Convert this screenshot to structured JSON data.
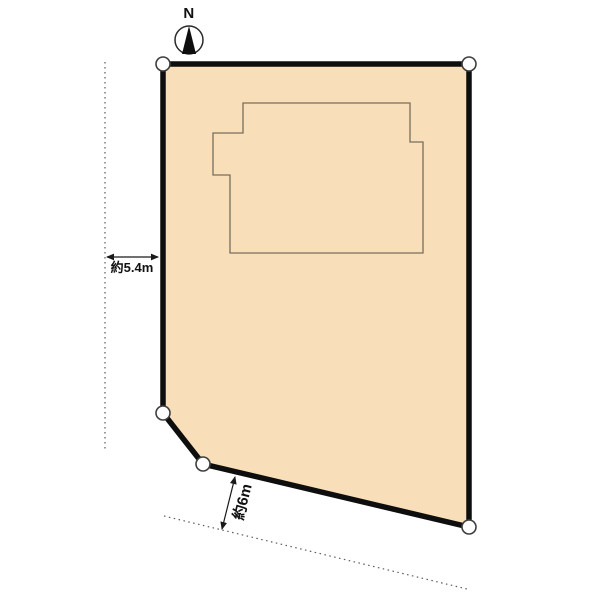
{
  "compass": {
    "label": "N"
  },
  "labels": {
    "left_dimension": "約5.4m",
    "road_dimension": "約6m"
  },
  "colors": {
    "background": "#ffffff",
    "plot_fill": "#f8dfb9",
    "plot_border": "#0e0e0e",
    "building_outline": "#776f5c",
    "boundary_dotted": "#5a5a5a",
    "vertex_fill": "#ffffff",
    "vertex_stroke": "#3e3e3e",
    "dimension_line": "#1a1a1a",
    "compass_ring": "#2a2a2a",
    "compass_needle": "#0e0e0e"
  },
  "diagram": {
    "type": "land-site-plan",
    "plot_points": "163,64 469,64 469,527 203,464 163,413",
    "building_points": "243,103 410,103 410,142 423,142 423,253 230,253 230,175 213,175 213,133 243,133",
    "vertex_markers": [
      [
        163,
        64
      ],
      [
        469,
        64
      ],
      [
        469,
        527
      ],
      [
        203,
        464
      ],
      [
        163,
        413
      ]
    ],
    "reference_line_left": {
      "x1": 105,
      "y1": 62,
      "x2": 105,
      "y2": 449
    },
    "road_line": {
      "x1": 164,
      "y1": 516,
      "x2": 467,
      "y2": 589
    },
    "left_dimension_arrow": {
      "x1": 107,
      "y1": 257,
      "x2": 158,
      "y2": 257
    },
    "road_dimension_arrow": {
      "x1": 235,
      "y1": 477,
      "x2": 222,
      "y2": 529
    },
    "compass_center": {
      "cx": 189,
      "cy": 40
    },
    "compass_needle_points": "189,26 182,54 196,54"
  }
}
